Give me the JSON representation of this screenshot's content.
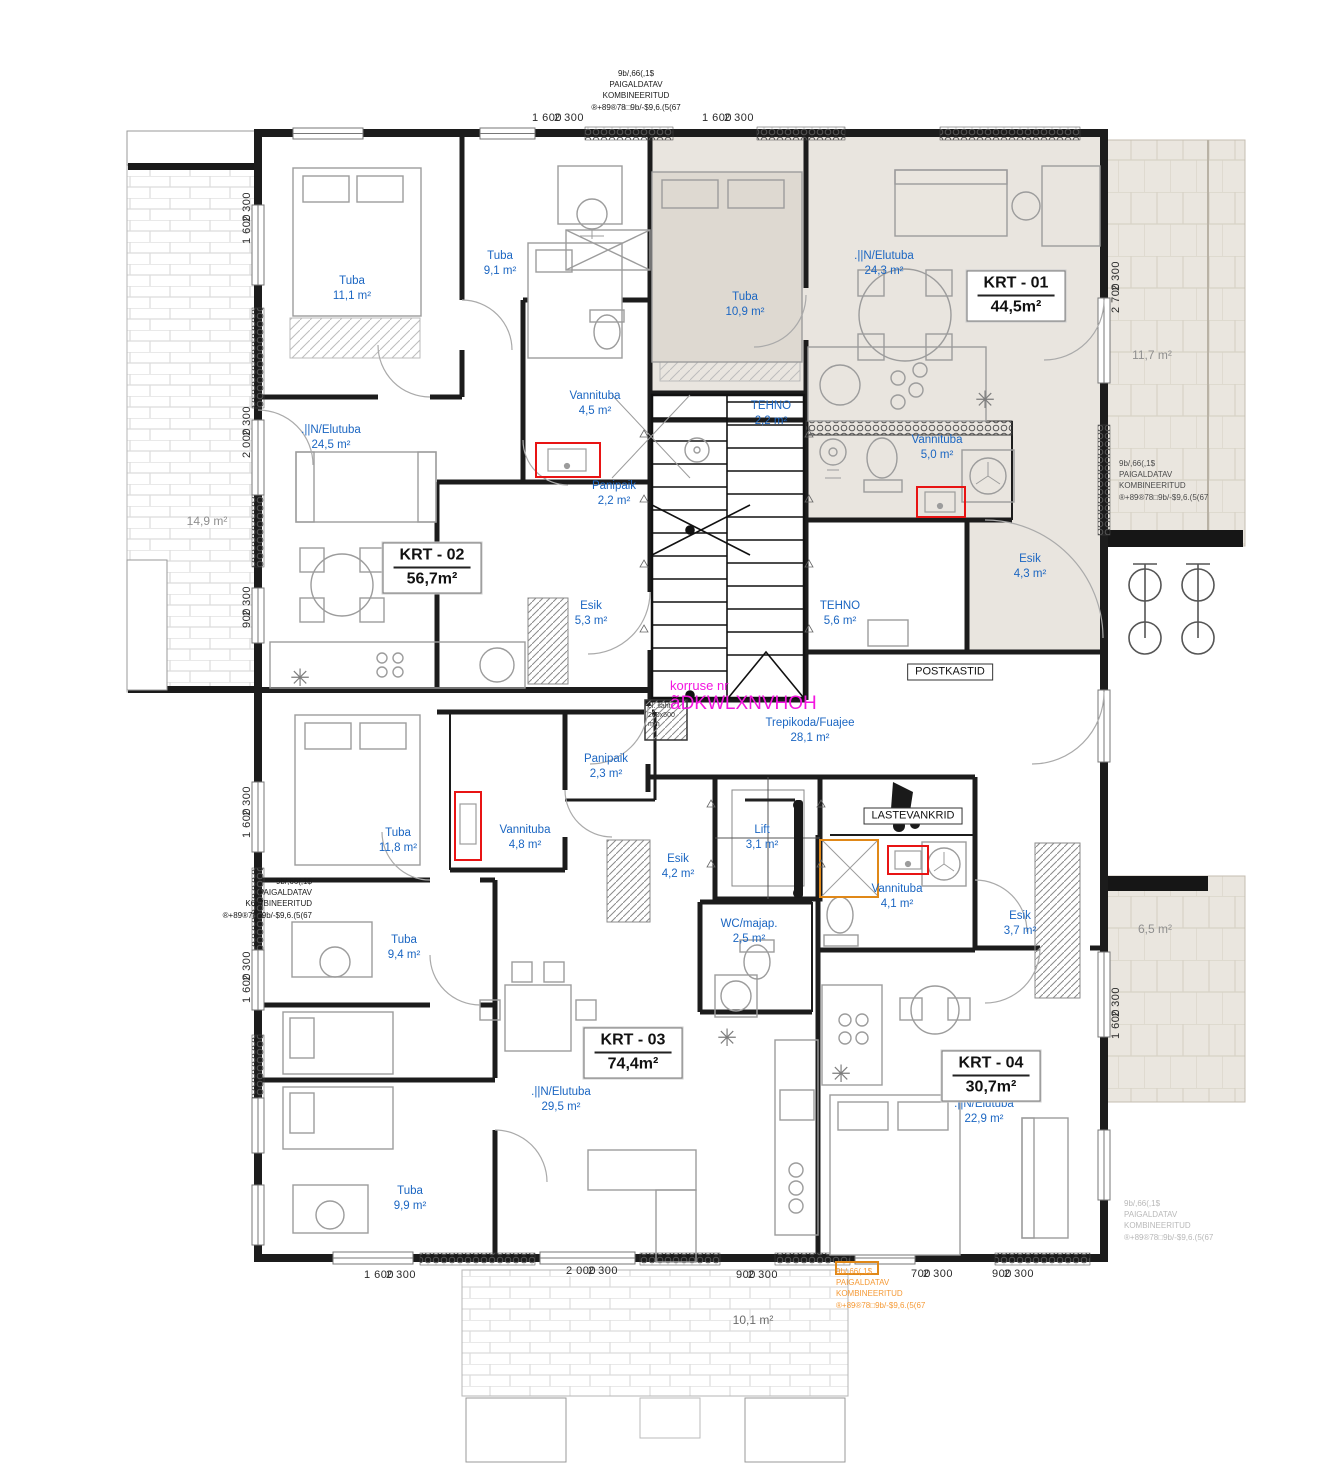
{
  "drawing": {
    "kind": "apartment floor plan"
  },
  "colors": {
    "room_label": "#1b66c2",
    "apartment_zone_fill": "#e9e5df",
    "wall": "#1c1c1c",
    "magenta_note": "#f316e0",
    "orange_note": "#f59a36",
    "gray_note": "#b9b9b9",
    "red_marker": "#e81414",
    "orange_marker": "#e08818"
  },
  "apartments": [
    {
      "id": "KRT - 01",
      "area": "44,5m²",
      "x": 1016,
      "y": 296
    },
    {
      "id": "KRT - 02",
      "area": "56,7m²",
      "x": 432,
      "y": 568
    },
    {
      "id": "KRT - 03",
      "area": "74,4m²",
      "x": 633,
      "y": 1053
    },
    {
      "id": "KRT - 04",
      "area": "30,7m²",
      "x": 991,
      "y": 1076
    }
  ],
  "rooms": [
    {
      "label": "Tuba",
      "area": "11,1 m²",
      "x": 352,
      "y": 289
    },
    {
      "label": "Tuba",
      "area": "9,1 m²",
      "x": 500,
      "y": 264
    },
    {
      "label": ".||N/Elutuba",
      "area": "24,5 m²",
      "x": 331,
      "y": 438
    },
    {
      "label": "Vannituba",
      "area": "4,5 m²",
      "x": 595,
      "y": 404
    },
    {
      "label": "Panipaik",
      "area": "2,2 m²",
      "x": 614,
      "y": 494
    },
    {
      "label": "Esik",
      "area": "5,3 m²",
      "x": 591,
      "y": 614
    },
    {
      "label": "Tuba",
      "area": "10,9 m²",
      "x": 745,
      "y": 305
    },
    {
      "label": ".||N/Elutuba",
      "area": "24,3 m²",
      "x": 884,
      "y": 264
    },
    {
      "label": "TEHNO",
      "area": "2,2 m²",
      "x": 771,
      "y": 414
    },
    {
      "label": "Vannituba",
      "area": "5,0 m²",
      "x": 937,
      "y": 448
    },
    {
      "label": "TEHNO",
      "area": "5,6 m²",
      "x": 840,
      "y": 614
    },
    {
      "label": "Esik",
      "area": "4,3 m²",
      "x": 1030,
      "y": 567
    },
    {
      "label": "Trepikoda/Fuajee",
      "area": "28,1 m²",
      "x": 810,
      "y": 731
    },
    {
      "label": "Panipaik",
      "area": "2,3 m²",
      "x": 606,
      "y": 767
    },
    {
      "label": "Vannituba",
      "area": "4,8 m²",
      "x": 525,
      "y": 838
    },
    {
      "label": "Tuba",
      "area": "11,8 m²",
      "x": 398,
      "y": 841
    },
    {
      "label": "Esik",
      "area": "4,2 m²",
      "x": 678,
      "y": 867
    },
    {
      "label": "Lift",
      "area": "3,1 m²",
      "x": 762,
      "y": 838
    },
    {
      "label": "Vannituba",
      "area": "4,1 m²",
      "x": 897,
      "y": 897
    },
    {
      "label": "WC/majap.",
      "area": "2,5 m²",
      "x": 749,
      "y": 932
    },
    {
      "label": "Esik",
      "area": "3,7 m²",
      "x": 1020,
      "y": 924
    },
    {
      "label": "Tuba",
      "area": "9,4 m²",
      "x": 404,
      "y": 948
    },
    {
      "label": ".||N/Elutuba",
      "area": "29,5 m²",
      "x": 561,
      "y": 1100
    },
    {
      "label": "Tuba",
      "area": "9,9 m²",
      "x": 410,
      "y": 1199
    },
    {
      "label": ".||N/Elutuba",
      "area": "22,9 m²",
      "x": 984,
      "y": 1112
    }
  ],
  "area_labels": [
    {
      "text": "14,9 m²",
      "x": 207,
      "y": 521,
      "tone": "gray"
    },
    {
      "text": "11,7 m²",
      "x": 1152,
      "y": 355,
      "tone": "gray"
    },
    {
      "text": "6,5 m²",
      "x": 1155,
      "y": 929,
      "tone": "gray"
    },
    {
      "text": "10,1 m²",
      "x": 753,
      "y": 1320,
      "tone": "dark"
    }
  ],
  "signs": [
    {
      "text": "POSTKASTID",
      "x": 950,
      "y": 672
    },
    {
      "text": "LASTEVANKRID",
      "x": 913,
      "y": 816
    }
  ],
  "floor_note": {
    "line1": "korruse nr",
    "line2": "ãDKWLXNVHOH",
    "x": 670,
    "y": 678
  },
  "shaft_note": {
    "l1": "el. šaht",
    "l2": "200x500",
    "l3": "mm",
    "x": 648,
    "y": 702
  },
  "annotation_lines": [
    "9b/,66(,1$",
    "PAIGALDATAV",
    "KOMBINEERITUD",
    "®+89®78□9b/-$9,6.(5(67"
  ],
  "annotations": [
    {
      "x": 636,
      "y": 68,
      "align": "center",
      "color": "#1a1a1a"
    },
    {
      "x": 312,
      "y": 876,
      "align": "right",
      "color": "#1a1a1a"
    },
    {
      "x": 1119,
      "y": 458,
      "align": "left",
      "color": "#4a4a4a"
    },
    {
      "x": 1124,
      "y": 1198,
      "align": "left",
      "color": "#b9b9b9"
    },
    {
      "x": 836,
      "y": 1266,
      "align": "left",
      "color": "#f59a36"
    }
  ],
  "dimensions": {
    "top": [
      {
        "a": "1 600",
        "b": "2 300",
        "x": 558,
        "y": 118
      },
      {
        "a": "1 600",
        "b": "2 300",
        "x": 728,
        "y": 118
      }
    ],
    "bottom": [
      {
        "a": "1 600",
        "b": "2 300",
        "x": 390,
        "y": 1275
      },
      {
        "a": "2 000",
        "b": "2 300",
        "x": 592,
        "y": 1271
      },
      {
        "a": "900",
        "b": "2 300",
        "x": 757,
        "y": 1275
      },
      {
        "a": "700",
        "b": "2 300",
        "x": 932,
        "y": 1274
      },
      {
        "a": "900",
        "b": "2 300",
        "x": 1013,
        "y": 1274
      }
    ],
    "left": [
      {
        "a": "1 600",
        "b": "2 300",
        "x": 247,
        "y": 218
      },
      {
        "a": "2 000",
        "b": "2 300",
        "x": 247,
        "y": 432
      },
      {
        "a": "900",
        "b": "2 300",
        "x": 247,
        "y": 607
      },
      {
        "a": "1 600",
        "b": "2 300",
        "x": 247,
        "y": 812
      },
      {
        "a": "1 600",
        "b": "2 300",
        "x": 247,
        "y": 977
      }
    ],
    "right": [
      {
        "a": "2 700",
        "b": "2 300",
        "x": 1116,
        "y": 287
      },
      {
        "a": "1 600",
        "b": "2 300",
        "x": 1116,
        "y": 1013
      }
    ]
  }
}
